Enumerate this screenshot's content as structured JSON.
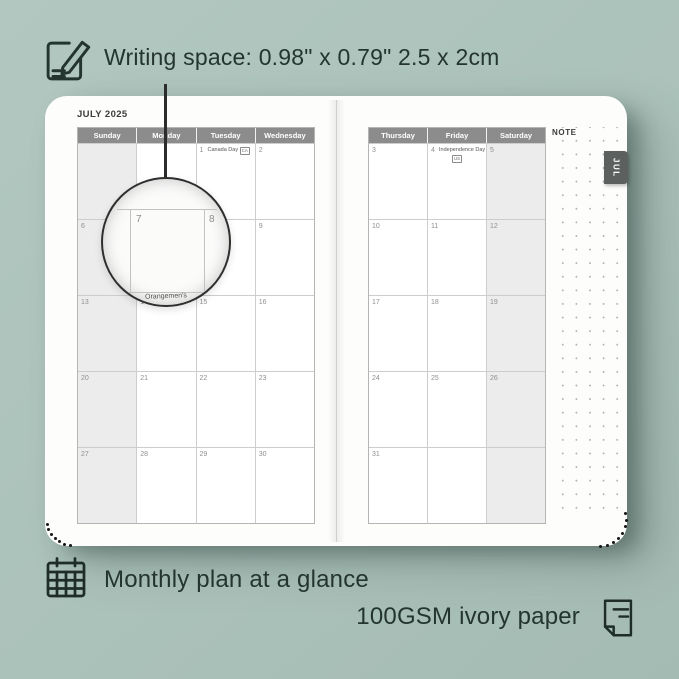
{
  "colors": {
    "background": "#abc2ba",
    "ink": "#243530",
    "page_white": "#fdfdfc",
    "header_gray": "#8c8c8c",
    "weekend_shade": "#ececec",
    "grid_line": "#cdcdcd",
    "day_number_gray": "#8f8f8f",
    "tab_gray": "#5c615f"
  },
  "annotations": {
    "writing_space": "Writing space: 0.98\" x 0.79\" 2.5 x 2cm",
    "monthly_plan": "Monthly plan at a glance",
    "paper_quality": "100GSM ivory paper"
  },
  "icons": {
    "top_left": "notepad-pencil-icon",
    "bottom_left": "calendar-grid-icon",
    "bottom_right": "paper-page-icon"
  },
  "planner": {
    "month_title": "JULY 2025",
    "note_label": "NOTE",
    "month_tab": "JUL",
    "left_page": {
      "headers": [
        "Sunday",
        "Monday",
        "Tuesday",
        "Wednesday"
      ],
      "shaded_column": 0,
      "rows": [
        [
          {
            "day": ""
          },
          {
            "day": ""
          },
          {
            "day": "1",
            "holiday": "Canada Day",
            "badge": "CA"
          },
          {
            "day": "2"
          }
        ],
        [
          {
            "day": "6"
          },
          {
            "day": "7"
          },
          {
            "day": "8"
          },
          {
            "day": "9"
          }
        ],
        [
          {
            "day": "13"
          },
          {
            "day": "14"
          },
          {
            "day": "15"
          },
          {
            "day": "16"
          }
        ],
        [
          {
            "day": "20"
          },
          {
            "day": "21"
          },
          {
            "day": "22"
          },
          {
            "day": "23"
          }
        ],
        [
          {
            "day": "27"
          },
          {
            "day": "28"
          },
          {
            "day": "29"
          },
          {
            "day": "30"
          }
        ]
      ]
    },
    "right_page": {
      "headers": [
        "Thursday",
        "Friday",
        "Saturday"
      ],
      "shaded_column": 2,
      "rows": [
        [
          {
            "day": "3"
          },
          {
            "day": "4",
            "holiday": "Independence Day",
            "badge": "US",
            "badge_below": true
          },
          {
            "day": "5"
          }
        ],
        [
          {
            "day": "10"
          },
          {
            "day": "11"
          },
          {
            "day": "12"
          }
        ],
        [
          {
            "day": "17"
          },
          {
            "day": "18"
          },
          {
            "day": "19"
          }
        ],
        [
          {
            "day": "24"
          },
          {
            "day": "25"
          },
          {
            "day": "26"
          }
        ],
        [
          {
            "day": "31"
          },
          {
            "day": ""
          },
          {
            "day": ""
          }
        ]
      ]
    },
    "magnifier": {
      "left_day": "7",
      "right_day": "8",
      "partial_holiday": "Orangemen's"
    }
  }
}
